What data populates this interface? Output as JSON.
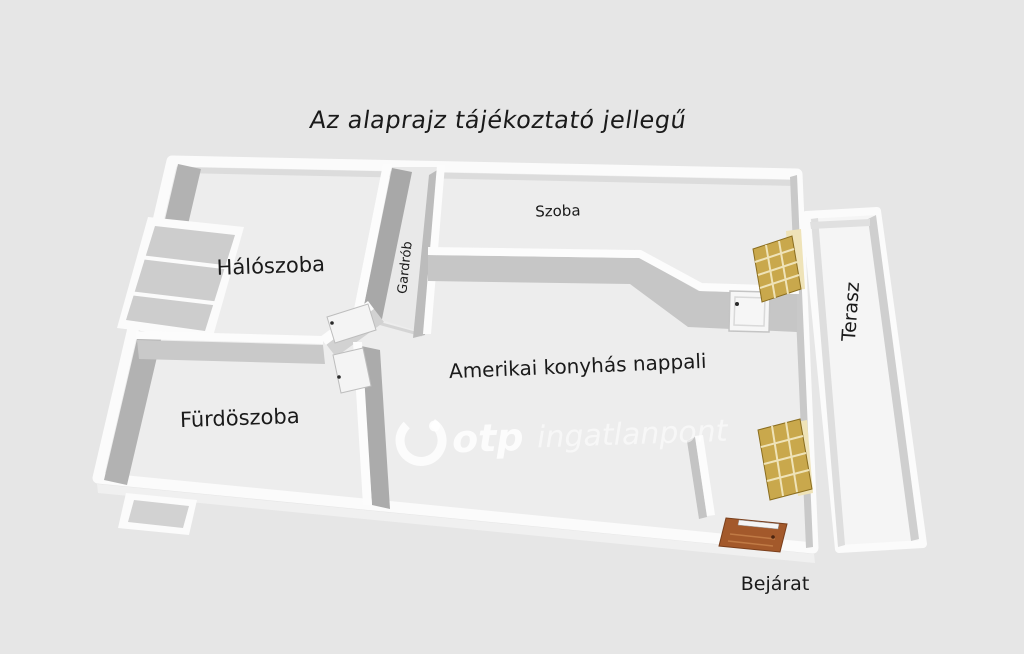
{
  "title": "Az alaprajz tájékoztató jellegű",
  "rooms": {
    "bedroom": "Hálószoba",
    "wardrobe": "Gardrób",
    "room": "Szoba",
    "bathroom": "Fürdöszoba",
    "living_room": "Amerikai konyhás nappali",
    "terrace": "Terasz",
    "entrance": "Bejárat"
  },
  "watermark": {
    "brand": "otp",
    "suffix": "ingatlanpont"
  },
  "colors": {
    "background": "#e6e6e6",
    "floor": "#ededed",
    "terrace_floor": "#f5f5f5",
    "wall_white": "#fcfcfc",
    "entrance_door": "#a3592b",
    "terrace_door": "#c9a84c",
    "terrace_door_pane": "#efe3b8",
    "label": "#1a1a1a",
    "watermark": "#ffffff"
  }
}
